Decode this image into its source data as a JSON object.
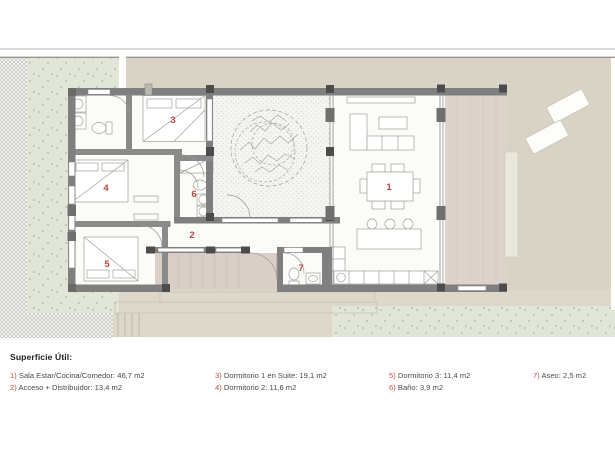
{
  "plan": {
    "rooms": [
      {
        "number": "1",
        "name": "Sala Estar/Cocina/Comedor"
      },
      {
        "number": "2",
        "name": "Acceso + Distribuidor"
      },
      {
        "number": "3",
        "name": "Dormitorio 1 en Suite"
      },
      {
        "number": "4",
        "name": "Dormitorio 2"
      },
      {
        "number": "5",
        "name": "Dormitorio 3"
      },
      {
        "number": "6",
        "name": "Baño"
      },
      {
        "number": "7",
        "name": "Aseo"
      }
    ],
    "colors": {
      "accent_red": "#bf4540",
      "wall_gray": "#7f7f7f",
      "column_gray": "#4c4c4c",
      "band_beige": "#d8d3c5",
      "garden_green": "#e2e6d9",
      "terrace_pink": "#ded3ca",
      "porch_steps": "#d9cfc6",
      "courtyard": "#f4f4f0"
    }
  },
  "legend": {
    "title": "Superficie Útil:",
    "columns": [
      {
        "items": [
          {
            "num": "1)",
            "text": " Sala Estar/Cocina/Comedor: 46,7 m2"
          },
          {
            "num": "2)",
            "text": " Acceso + Distribuidor: 13,4 m2"
          }
        ]
      },
      {
        "items": [
          {
            "num": "3)",
            "text": " Dormitorio 1 en Suite: 19,1 m2"
          },
          {
            "num": "4)",
            "text": " Dormitorio 2: 11,6 m2"
          }
        ]
      },
      {
        "items": [
          {
            "num": "5)",
            "text": " Dormitorio 3: 11,4 m2"
          },
          {
            "num": "6)",
            "text": " Baño: 3,9 m2"
          }
        ]
      },
      {
        "items": [
          {
            "num": "7)",
            "text": " Aseo: 2,5 m2"
          }
        ]
      }
    ]
  }
}
